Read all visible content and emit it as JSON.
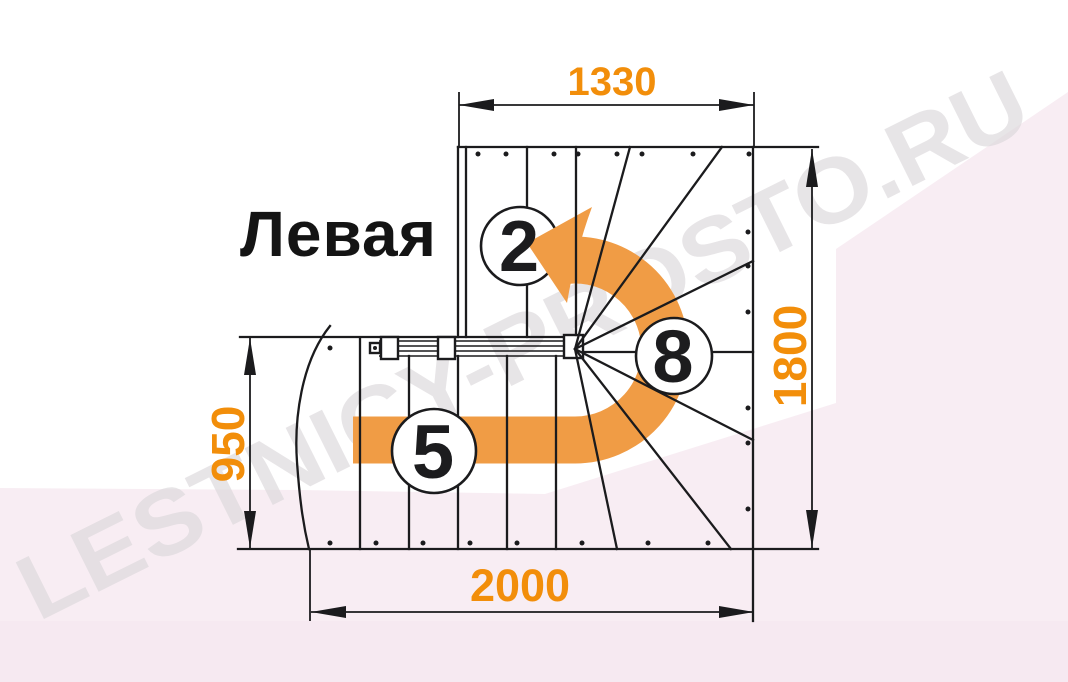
{
  "drawing": {
    "title": "Левая",
    "watermark": "LESTNICY-PROSTO.RU",
    "dimensions": {
      "top": "1330",
      "right": "1800",
      "left": "950",
      "bottom": "2000"
    },
    "steps": {
      "upper": "2",
      "lower": "5",
      "winder": "8"
    },
    "colors": {
      "dimension_text": "#F28E0A",
      "arrow_orange": "#F09C45",
      "line_black": "#1b1b1d",
      "background_pink": "#f8edf3",
      "background_pink_deep": "#f6e9f1",
      "watermark_gray": "#dcd8db"
    }
  }
}
